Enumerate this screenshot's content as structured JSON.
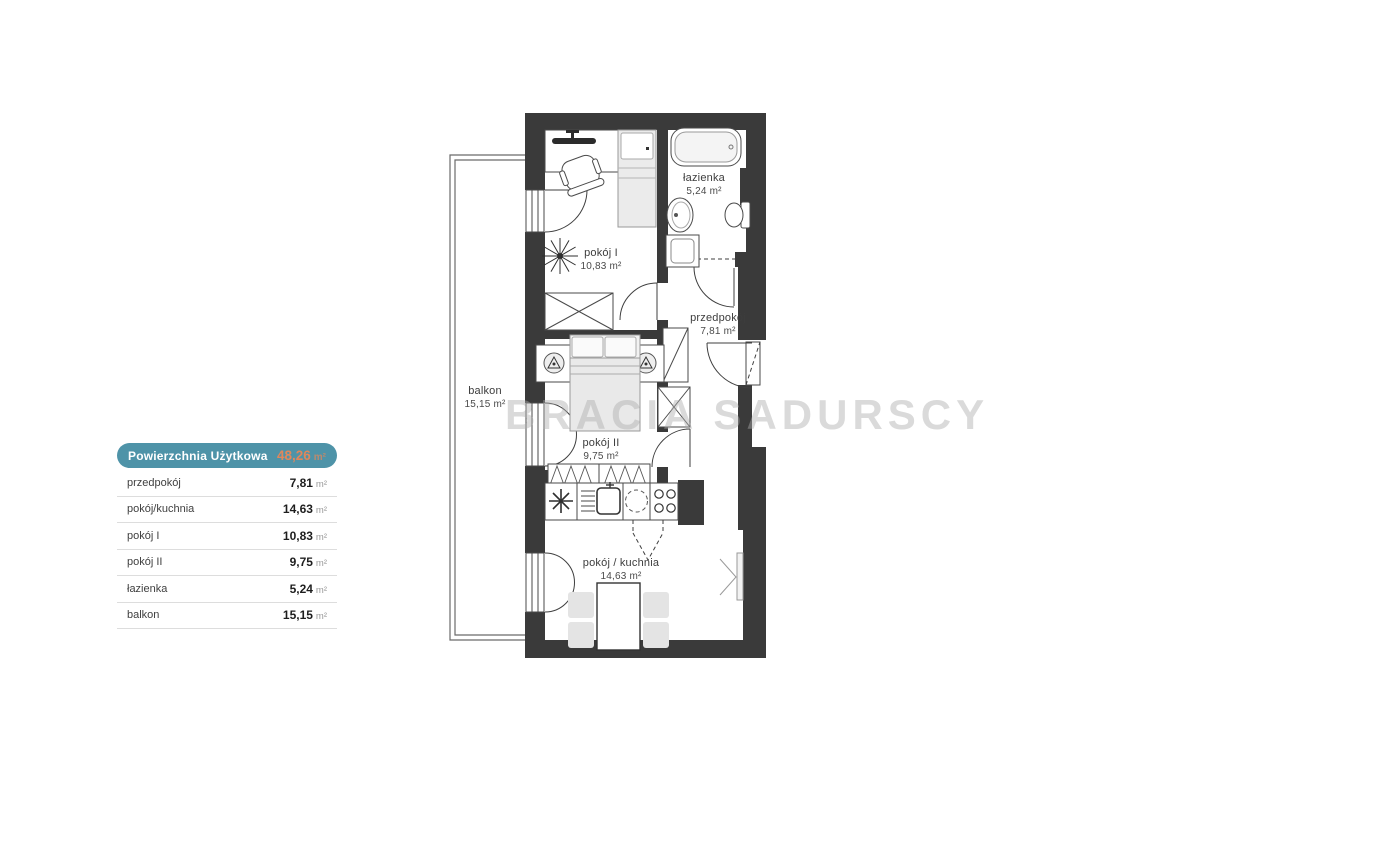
{
  "legend": {
    "header": {
      "label": "Powierzchnia Użytkowa",
      "value": "48,26",
      "unit": "m²"
    },
    "rows": [
      {
        "label": "przedpokój",
        "value": "7,81",
        "unit": "m²"
      },
      {
        "label": "pokój/kuchnia",
        "value": "14,63",
        "unit": "m²"
      },
      {
        "label": "pokój I",
        "value": "10,83",
        "unit": "m²"
      },
      {
        "label": "pokój II",
        "value": "9,75",
        "unit": "m²"
      },
      {
        "label": "łazienka",
        "value": "5,24",
        "unit": "m²"
      },
      {
        "label": "balkon",
        "value": "15,15",
        "unit": "m²"
      }
    ]
  },
  "plan": {
    "rooms": [
      {
        "name": "pokój I",
        "area": "10,83 m²"
      },
      {
        "name": "łazienka",
        "area": "5,24 m²"
      },
      {
        "name": "przedpokój",
        "area": "7,81 m²"
      },
      {
        "name": "pokój II",
        "area": "9,75 m²"
      },
      {
        "name": "pokój / kuchnia",
        "area": "14,63 m²"
      },
      {
        "name": "balkon",
        "area": "15,15 m²"
      }
    ],
    "watermark": "BRACIA SADURSCY"
  },
  "colors": {
    "teal": "#4E93A8",
    "orange": "#E0875B",
    "wall": "#3A3A3A"
  }
}
